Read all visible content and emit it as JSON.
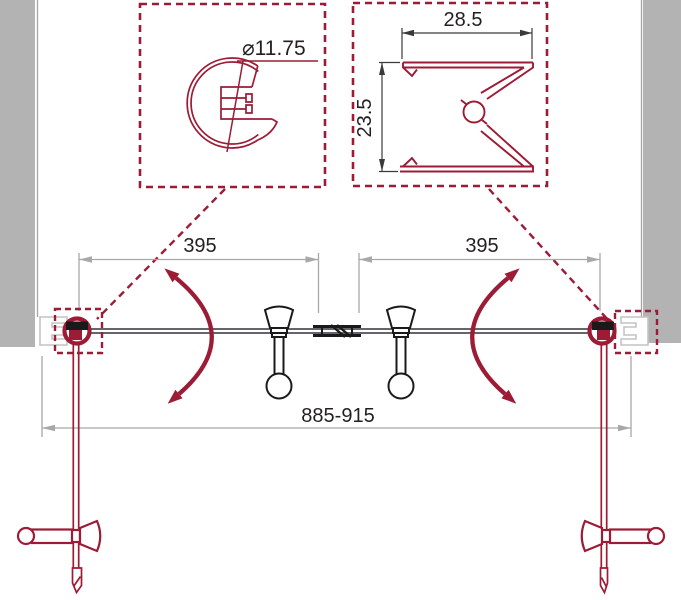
{
  "drawing": {
    "type": "shower-door-technical-plan",
    "details": {
      "round_profile": {
        "diameter_label": "⌀11.75"
      },
      "wall_profile": {
        "width_label": "28.5",
        "depth_label": "23.5"
      }
    },
    "plan": {
      "left_door_width": "395",
      "right_door_width": "395",
      "overall_width_range": "885-915"
    },
    "colors": {
      "accent_red": "#9c1b35",
      "wall_gray": "#b3b3b3",
      "line_dark": "#1a1a1a",
      "dimension_gray": "#a8a8a8",
      "text_dark": "#231f20",
      "profile_gray": "#c4c4c4"
    }
  }
}
